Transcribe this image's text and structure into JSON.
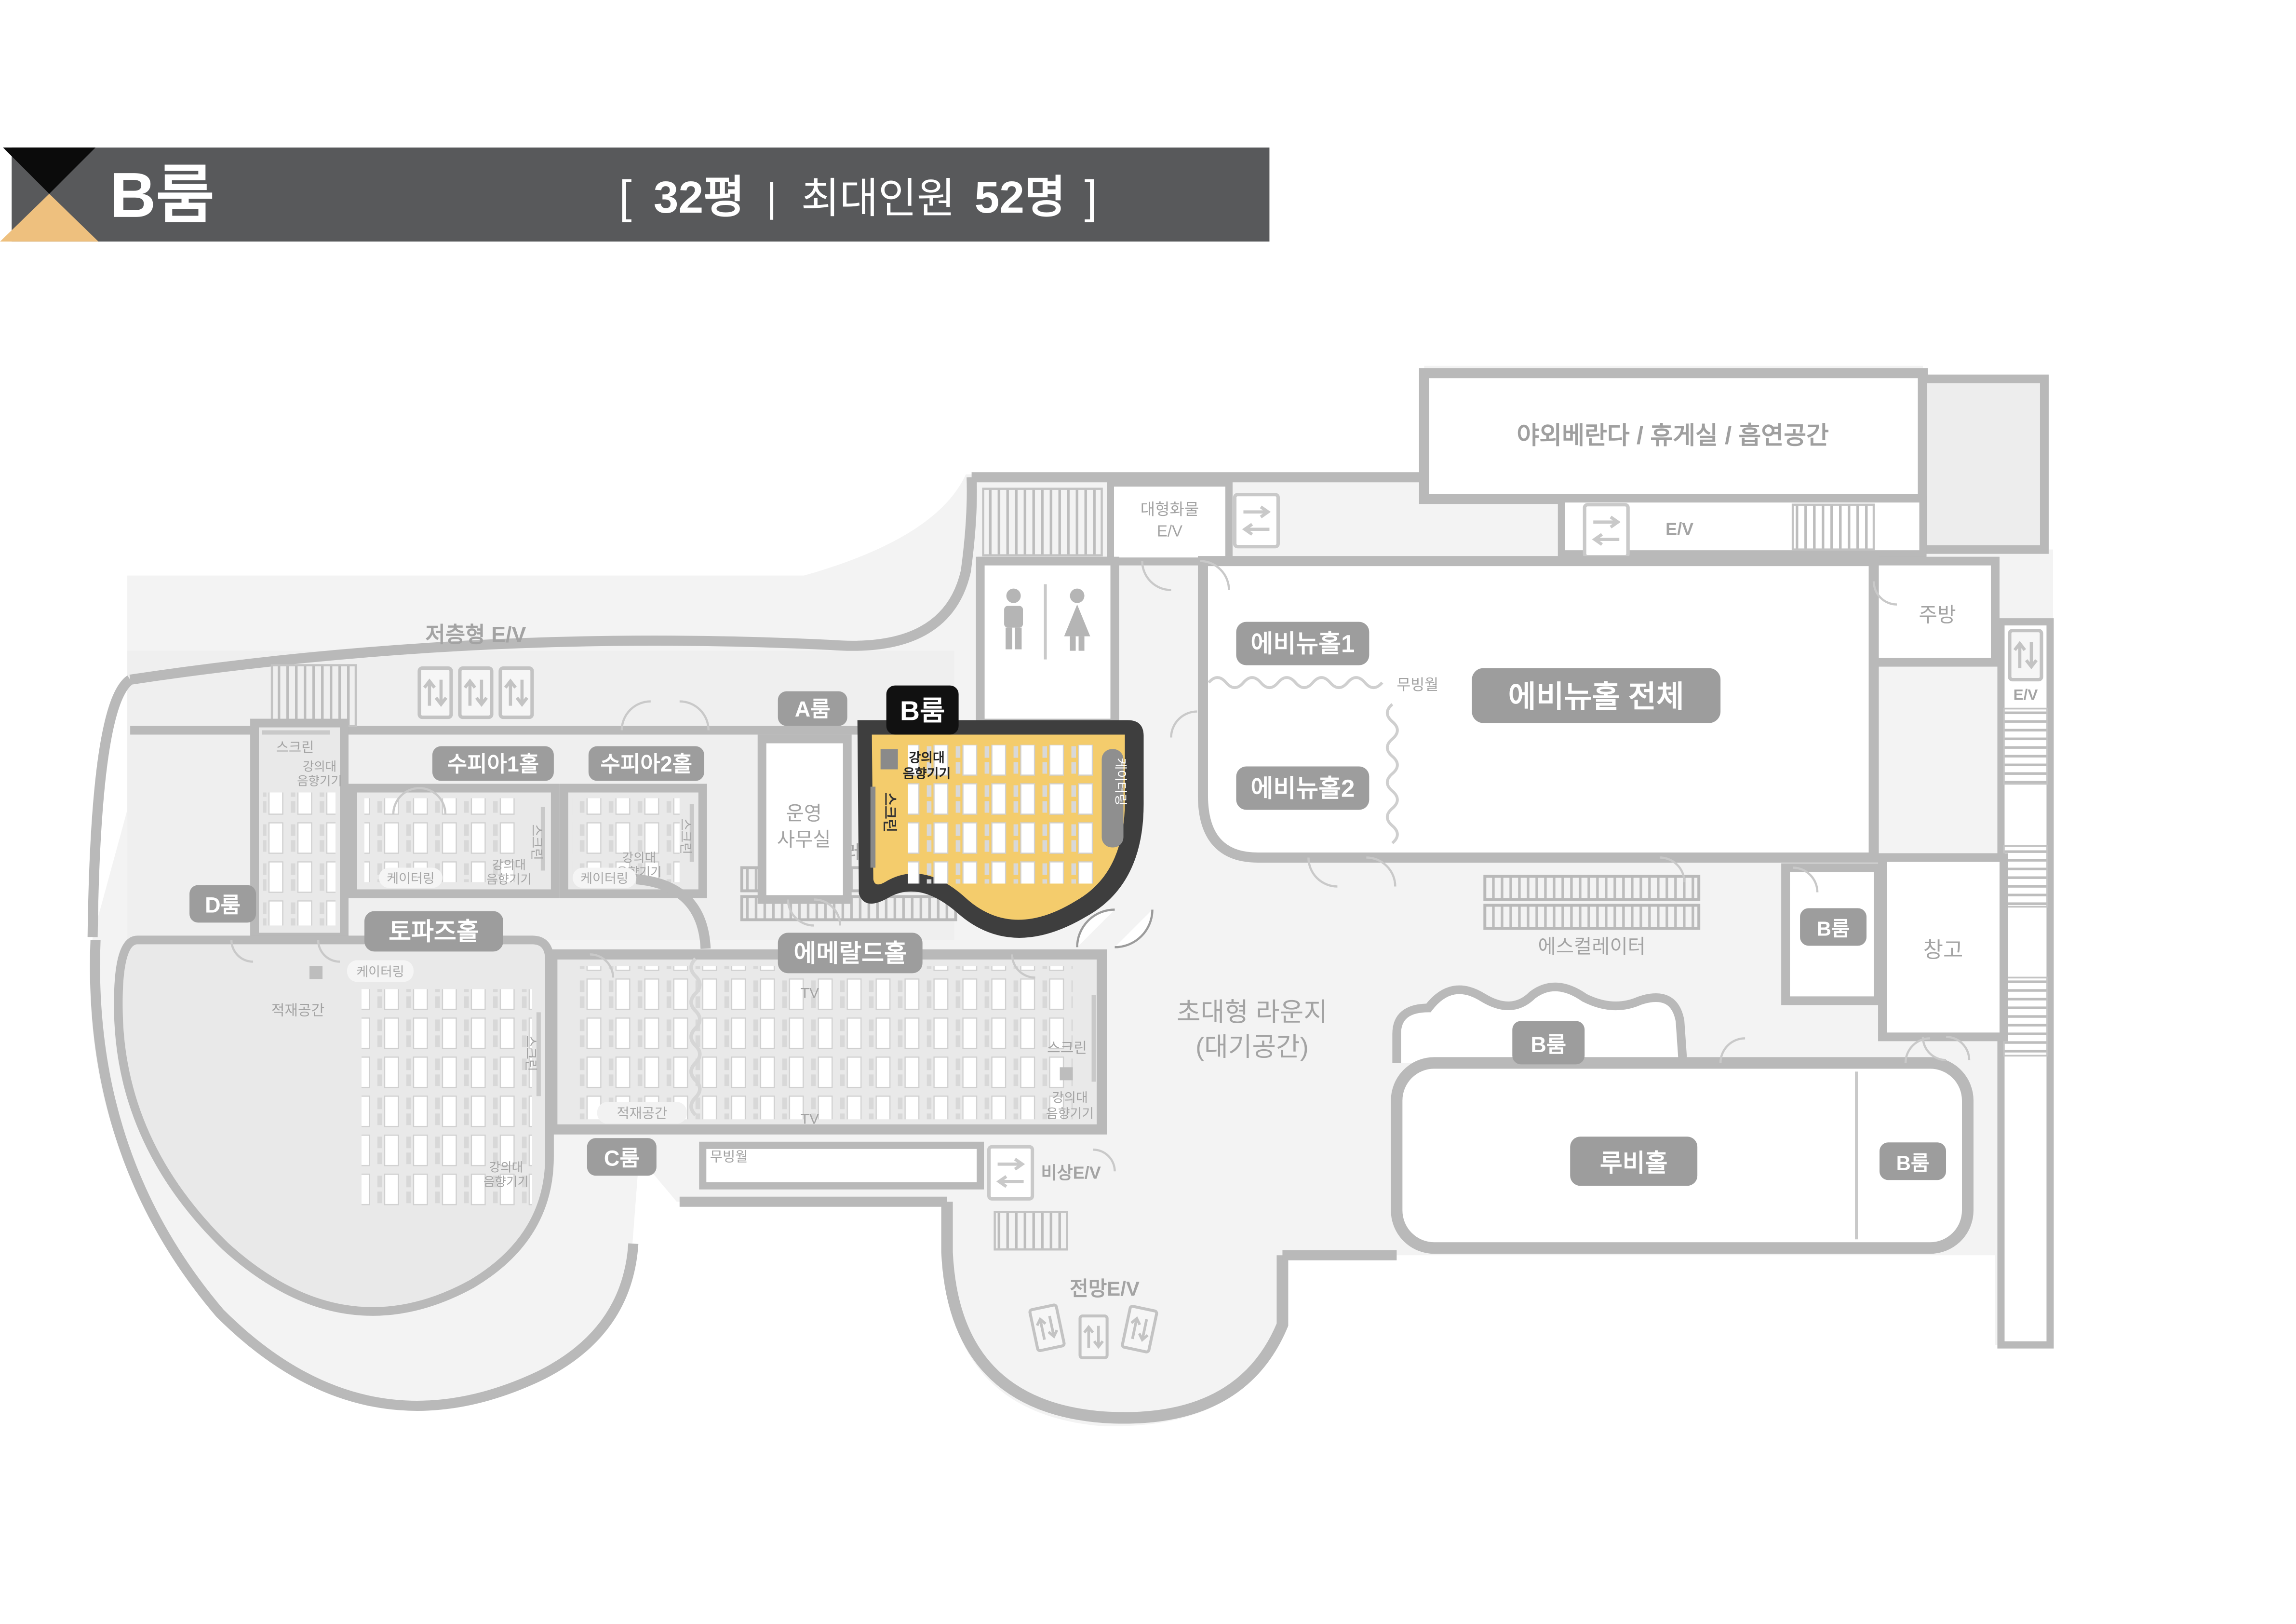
{
  "header": {
    "title": "B룸",
    "info": {
      "open": "[",
      "area": "32평",
      "sep": "|",
      "capacity_label": "최대인원",
      "capacity": "52명",
      "close": "]"
    },
    "logo": {
      "top_triangle": "#0b0b0b",
      "bottom_triangle": "#eec07e",
      "bar": "#58595b"
    }
  },
  "plan": {
    "halls": {
      "low_rise_ev": "저층형 E/V",
      "d_room": "D룸",
      "supia1": "수피아1홀",
      "supia2": "수피아2홀",
      "a_room": "A룸",
      "b_room": "B룸",
      "op_office_l1": "운영",
      "op_office_l2": "사무실",
      "topaz": "토파즈홀",
      "emerald": "에메랄드홀",
      "c_room": "C룸",
      "avenue1": "에비뉴홀1",
      "avenue2": "에비뉴홀2",
      "avenue_all": "에비뉴홀 전체",
      "veranda": "야외베란다 / 휴게실 / 흡연공간",
      "buffet_l1": "뷔페",
      "buffet_l2": "테이블",
      "kitchen": "주방",
      "storage": "창고",
      "ruby": "루비홀",
      "lounge_l1": "초대형 라운지",
      "lounge_l2": "(대기공간)"
    },
    "labels": {
      "escalator": "에스컬레이터",
      "moving_wall": "무빙월",
      "screen": "스크린",
      "podium_l1": "강의대",
      "podium_l2": "음향기기",
      "catering": "케이터링",
      "stack_space": "적재공간",
      "tv": "TV",
      "ev": "E/V",
      "cargo_ev_l1": "대형화물",
      "cargo_ev_l2": "E/V",
      "emergency_ev": "비상E/V",
      "view_ev": "전망E/V"
    },
    "colors": {
      "wall": "#b9b9b9",
      "hall_fill": "#e9e9e9",
      "lounge_fill": "#f3f3f3",
      "badge": "#9d9d9d",
      "highlight_fill": "#f4cc6c",
      "highlight_wall": "#3e3e3e",
      "highlight_badge": "#111111"
    }
  }
}
